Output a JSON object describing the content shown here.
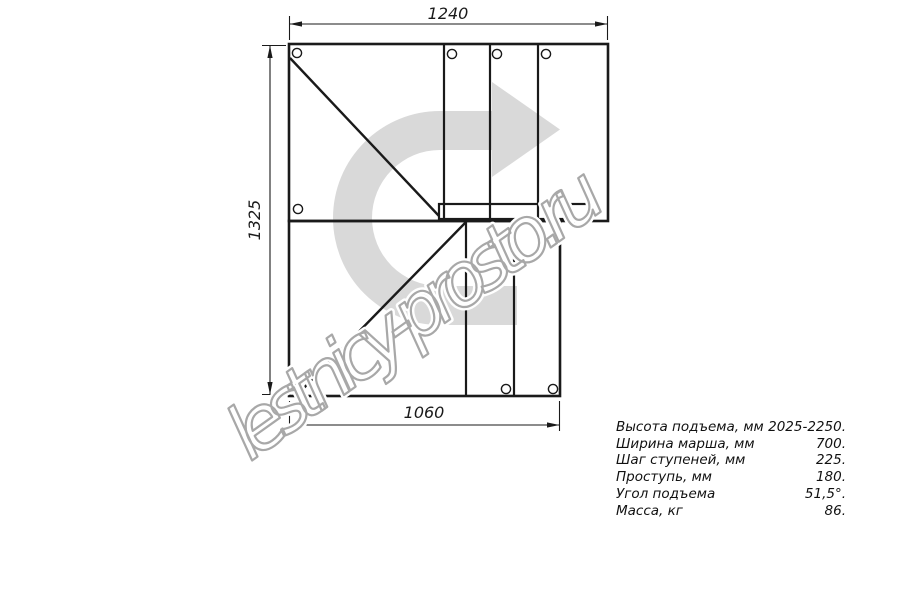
{
  "drawing": {
    "title": "staircase-plan-view",
    "dimensions": {
      "top_width": "1240",
      "left_height": "1325",
      "bottom_width": "1060"
    },
    "watermark": "lestnicy-prosto.ru",
    "colors": {
      "line": "#1a1a1a",
      "arrow_fill": "#d9d9d9",
      "watermark_stroke": "#a8a8a8",
      "watermark_halo": "#ffffff"
    }
  },
  "specs": {
    "rows": [
      {
        "label": "Высота подъема, мм",
        "value": "2025-2250."
      },
      {
        "label": "Ширина марша, мм",
        "value": "700."
      },
      {
        "label": "Шаг ступеней, мм",
        "value": "225."
      },
      {
        "label": "Проступь, мм",
        "value": "180."
      },
      {
        "label": "Угол подъема",
        "value": "51,5°."
      },
      {
        "label": "Масса, кг",
        "value": "86."
      }
    ]
  }
}
